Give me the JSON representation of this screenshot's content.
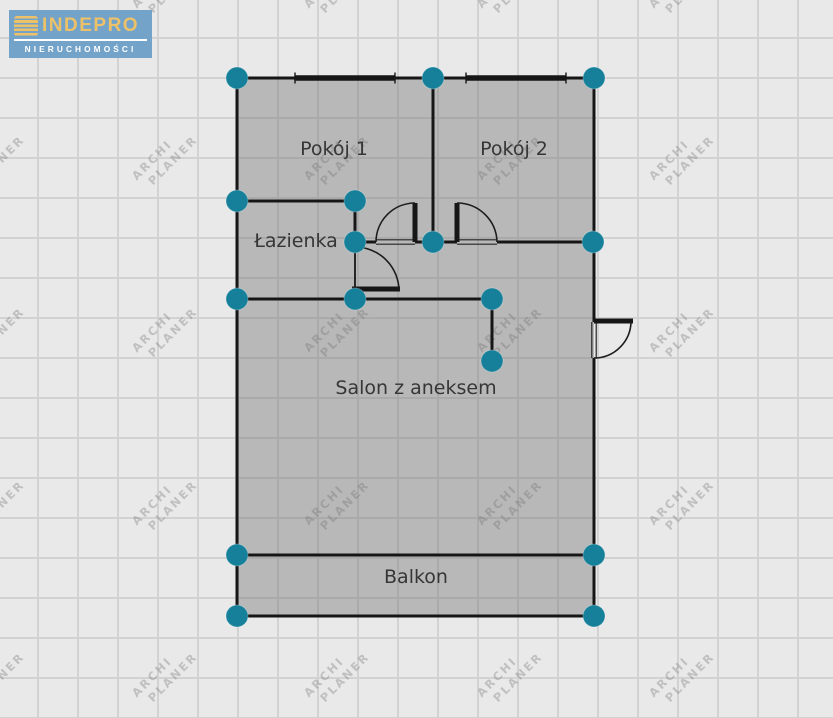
{
  "logo": {
    "title": "INDEPRO",
    "subtitle": "NIERUCHOMOŚCI",
    "bg_color": "#74a3ca",
    "title_color": "#ecc168",
    "subtitle_color": "#ffffff",
    "icon": "layers-stack-icon"
  },
  "watermark": {
    "line1": "ARCHI",
    "line2": "PLANER",
    "cols": [
      -8,
      165,
      337,
      510,
      682
    ],
    "rows": [
      -14,
      158,
      330,
      503,
      675
    ]
  },
  "canvas": {
    "bg_color": "#e9e9e9",
    "grid_color": "#d2d2d2",
    "grid_size": 40
  },
  "plan": {
    "fill": "rgba(110,110,110,0.40)",
    "wall_color": "#161616",
    "handle_color": "#16809a",
    "handle_radius": 11,
    "outline": [
      [
        237,
        78
      ],
      [
        594,
        78
      ],
      [
        594,
        616
      ],
      [
        237,
        616
      ]
    ],
    "rooms": [
      {
        "name": "Pokój 1",
        "label_x": 334,
        "label_y": 149
      },
      {
        "name": "Pokój 2",
        "label_x": 514,
        "label_y": 149
      },
      {
        "name": "Łazienka",
        "label_x": 296,
        "label_y": 241
      },
      {
        "name": "Salon z aneksem",
        "label_x": 416,
        "label_y": 388
      },
      {
        "name": "Balkon",
        "label_x": 416,
        "label_y": 577
      }
    ],
    "walls": [
      [
        237,
        78,
        594,
        78
      ],
      [
        237,
        78,
        237,
        616
      ],
      [
        594,
        78,
        594,
        322
      ],
      [
        594,
        358,
        594,
        616
      ],
      [
        433,
        78,
        433,
        242
      ],
      [
        237,
        201,
        355,
        201
      ],
      [
        355,
        201,
        355,
        242
      ],
      [
        355,
        242,
        376,
        242
      ],
      [
        415,
        242,
        457,
        242
      ],
      [
        497,
        242,
        594,
        242
      ],
      [
        237,
        299,
        492,
        299
      ],
      [
        492,
        299,
        492,
        361
      ],
      [
        237,
        555,
        594,
        555
      ],
      [
        237,
        616,
        594,
        616
      ],
      [
        355,
        242,
        355,
        289,
        1.8
      ]
    ],
    "thresholds": [
      {
        "x1": 376,
        "y1": 242,
        "x2": 415,
        "y2": 242
      },
      {
        "x1": 457,
        "y1": 242,
        "x2": 497,
        "y2": 242
      },
      {
        "x1": 594,
        "y1": 322,
        "x2": 594,
        "y2": 358
      }
    ],
    "windows": [
      [
        295,
        78,
        395,
        78
      ],
      [
        466,
        78,
        566,
        78
      ]
    ],
    "doors": [
      {
        "leaf": [
          415,
          203,
          415,
          242
        ],
        "arc": {
          "sx": 415,
          "sy": 203,
          "ex": 376,
          "ey": 242,
          "r": 39,
          "sweep": 0
        }
      },
      {
        "leaf": [
          457,
          203,
          457,
          242
        ],
        "arc": {
          "sx": 457,
          "sy": 203,
          "ex": 497,
          "ey": 242,
          "r": 40,
          "sweep": 1
        }
      },
      {
        "leaf": [
          352,
          289,
          400,
          289
        ],
        "arc": {
          "sx": 355,
          "sy": 247,
          "ex": 399,
          "ey": 291,
          "r": 44,
          "sweep": 1
        }
      },
      {
        "leaf": [
          594,
          321,
          633,
          321
        ],
        "arc": {
          "sx": 631,
          "sy": 321,
          "ex": 594,
          "ey": 358,
          "r": 37,
          "sweep": 1
        }
      }
    ],
    "handles": [
      [
        237,
        78
      ],
      [
        433,
        78
      ],
      [
        594,
        78
      ],
      [
        237,
        201
      ],
      [
        355,
        201
      ],
      [
        355,
        242
      ],
      [
        433,
        242
      ],
      [
        593,
        242
      ],
      [
        237,
        299
      ],
      [
        355,
        299
      ],
      [
        492,
        299
      ],
      [
        492,
        361
      ],
      [
        237,
        555
      ],
      [
        594,
        555
      ],
      [
        237,
        616
      ],
      [
        594,
        616
      ]
    ]
  }
}
